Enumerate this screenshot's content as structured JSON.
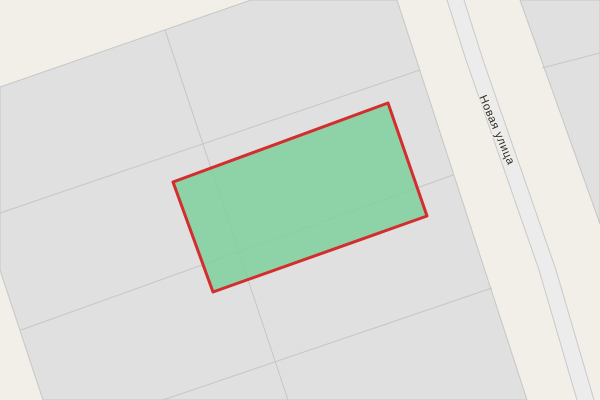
{
  "map": {
    "street_label": {
      "text": "Новая улица",
      "x": 479,
      "y": 97,
      "rotation_deg": 67,
      "font_size": 11.5
    },
    "colors": {
      "background": "#f2efe9",
      "parcel_fill": "#e0e0e0",
      "parcel_line": "#c6c6c6",
      "road_fill": "#ececec",
      "road_edge": "#c9c9c9",
      "highlight_fill": "#7fcf9c",
      "highlight_border": "#d32d2d",
      "label_color": "#2e2e2e",
      "label_halo": "#f0eee8"
    },
    "blocks": [
      {
        "name": "parcel-block-main",
        "points": [
          [
            0,
            87
          ],
          [
            251,
            0
          ],
          [
            397,
            0
          ],
          [
            527,
            400
          ],
          [
            43,
            400
          ],
          [
            0,
            270
          ]
        ]
      },
      {
        "name": "parcel-block-northeast",
        "points": [
          [
            520,
            0
          ],
          [
            600,
            0
          ],
          [
            600,
            224
          ]
        ]
      }
    ],
    "parcel_lines": [
      {
        "name": "parcel-boundary-line",
        "points": [
          [
            0,
            213
          ],
          [
            420,
            70
          ]
        ]
      },
      {
        "name": "parcel-boundary-line",
        "points": [
          [
            21,
            330
          ],
          [
            453,
            175
          ]
        ]
      },
      {
        "name": "parcel-boundary-line",
        "points": [
          [
            163,
            400
          ],
          [
            492,
            288
          ]
        ]
      },
      {
        "name": "parcel-boundary-line",
        "points": [
          [
            165,
            30
          ],
          [
            288,
            400
          ]
        ]
      },
      {
        "name": "parcel-boundary-line",
        "points": [
          [
            542,
            68
          ],
          [
            600,
            53
          ]
        ]
      }
    ],
    "road": {
      "surface_points": [
        [
          447,
          0
        ],
        [
          464,
          0
        ],
        [
          483,
          60
        ],
        [
          556,
          270
        ],
        [
          594,
          400
        ],
        [
          577,
          400
        ],
        [
          539,
          270
        ],
        [
          466,
          60
        ]
      ],
      "edges": [
        {
          "name": "road-edge-line",
          "points": [
            [
              447,
              0
            ],
            [
              466,
              60
            ],
            [
              539,
              270
            ],
            [
              577,
              400
            ]
          ]
        },
        {
          "name": "road-edge-line",
          "points": [
            [
              464,
              0
            ],
            [
              483,
              60
            ],
            [
              556,
              270
            ],
            [
              594,
              400
            ]
          ]
        }
      ]
    },
    "highlight_parcel": {
      "points": [
        [
          388,
          103
        ],
        [
          427,
          216
        ],
        [
          213,
          292
        ],
        [
          173,
          182
        ]
      ],
      "fill_opacity": 0.85,
      "border_width": 3
    }
  }
}
